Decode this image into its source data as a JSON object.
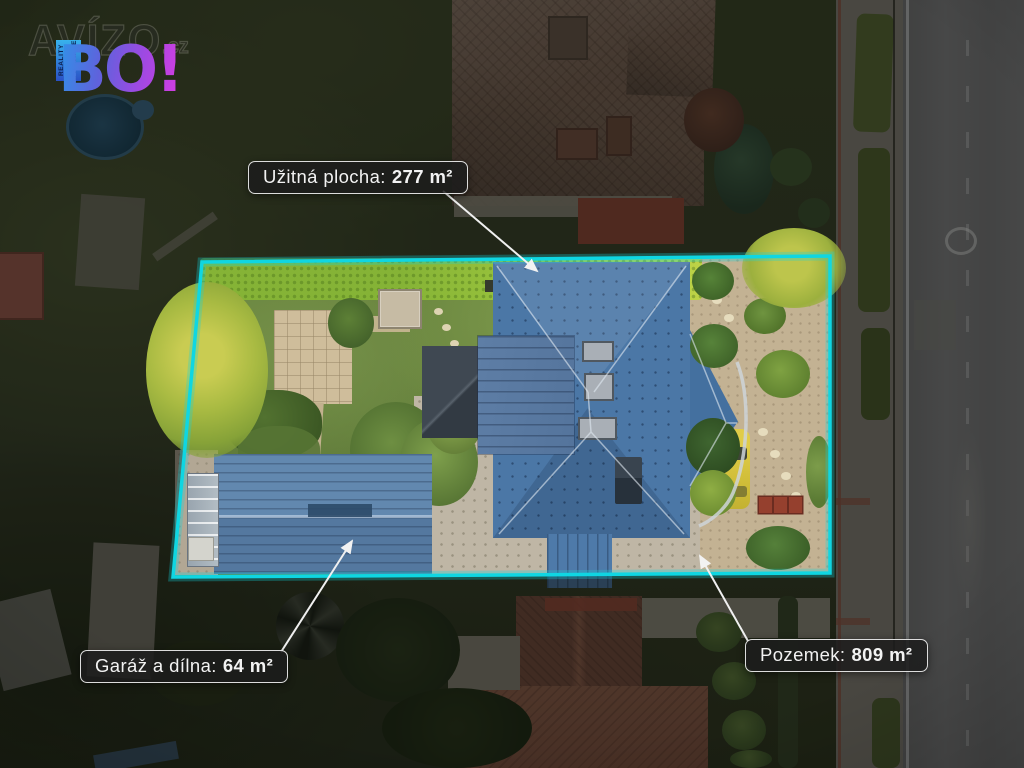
{
  "image": {
    "description": "Aerial drone photo of a real-estate listing: plot outlined in cyan containing a blue-roofed house, blue-roofed garage, garden, courtyard; surroundings dimmed; road on the right.",
    "colors": {
      "boundary": "#0FD6E2",
      "label_background": "rgba(28,28,28,0.85)",
      "label_border": "#FFFFFF",
      "label_text": "#F2F2F2",
      "main_roof": "#4B77A6",
      "garage_roof": "#5A7EA6",
      "logo_gradient_start": "#2F93E8",
      "logo_gradient_end": "#D83CE2"
    }
  },
  "logo": {
    "brand": "AVÍZO",
    "domain": ".cz",
    "name": "BO!",
    "tagline_1": "REALITY",
    "tagline_2": "& FINANCE"
  },
  "annotations": {
    "usable_area": {
      "label": "Užitná plocha:",
      "value": "277 m²"
    },
    "garage": {
      "label": "Garáž a dílna:",
      "value": "64 m²"
    },
    "plot": {
      "label": "Pozemek:",
      "value": "809 m²"
    }
  }
}
